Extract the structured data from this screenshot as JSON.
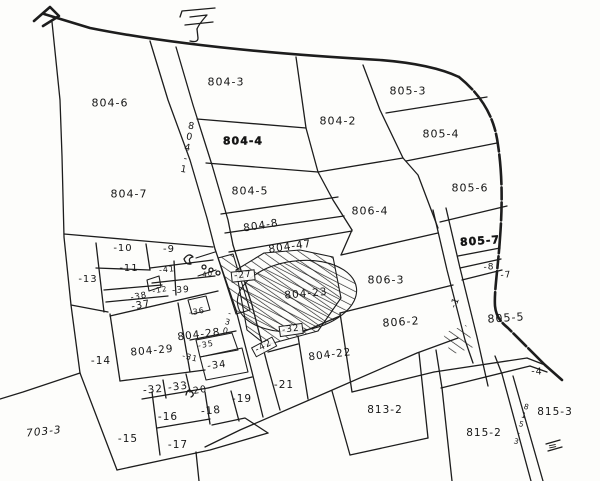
{
  "map": {
    "title_character": "字",
    "background": "#fdfdfb",
    "line_color": "#1d1d1d",
    "labels": [
      {
        "id": "804-6",
        "text": "804-6",
        "x": 110,
        "y": 103
      },
      {
        "id": "804-3",
        "text": "804-3",
        "x": 226,
        "y": 82
      },
      {
        "id": "804-4",
        "text": "804-4",
        "x": 243,
        "y": 141,
        "bold": true
      },
      {
        "id": "804-2",
        "text": "804-2",
        "x": 338,
        "y": 121
      },
      {
        "id": "805-3",
        "text": "805-3",
        "x": 408,
        "y": 91
      },
      {
        "id": "805-4",
        "text": "805-4",
        "x": 441,
        "y": 134
      },
      {
        "id": "805-6",
        "text": "805-6",
        "x": 470,
        "y": 188
      },
      {
        "id": "804-7",
        "text": "804-7",
        "x": 129,
        "y": 194
      },
      {
        "id": "804-5",
        "text": "804-5",
        "x": 250,
        "y": 191
      },
      {
        "id": "804-8",
        "text": "804-8",
        "x": 261,
        "y": 226,
        "rot": -9,
        "size": 10.5
      },
      {
        "id": "806-4",
        "text": "806-4",
        "x": 370,
        "y": 211
      },
      {
        "id": "804-47",
        "text": "804-47",
        "x": 290,
        "y": 247,
        "rot": -8,
        "size": 10.5
      },
      {
        "id": "805-7",
        "text": "805-7",
        "x": 480,
        "y": 241,
        "rot": -4,
        "bold": true
      },
      {
        "id": "m8",
        "text": "-8",
        "x": 489,
        "y": 268,
        "size": 9
      },
      {
        "id": "m7",
        "text": "-7",
        "x": 506,
        "y": 276,
        "size": 9,
        "rot": -4
      },
      {
        "id": "m1",
        "text": "-1",
        "x": 456,
        "y": 303,
        "size": 9,
        "rot": -70
      },
      {
        "id": "805-5",
        "text": "805-5",
        "x": 506,
        "y": 318,
        "rot": -4
      },
      {
        "id": "806-3",
        "text": "806-3",
        "x": 386,
        "y": 280
      },
      {
        "id": "806-2",
        "text": "806-2",
        "x": 401,
        "y": 322,
        "rot": -4
      },
      {
        "id": "804-23",
        "text": "804-23",
        "x": 306,
        "y": 294,
        "rot": -5,
        "size": 10.5
      },
      {
        "id": "m27",
        "text": "-27",
        "x": 243,
        "y": 276,
        "size": 9,
        "rot": -6,
        "boxed": true
      },
      {
        "id": "m10",
        "text": "-10",
        "x": 123,
        "y": 249,
        "size": 10
      },
      {
        "id": "m9",
        "text": "-9",
        "x": 169,
        "y": 250,
        "size": 10
      },
      {
        "id": "m13",
        "text": "-13",
        "x": 88,
        "y": 280,
        "size": 10
      },
      {
        "id": "m11",
        "text": "-11",
        "x": 129,
        "y": 269,
        "size": 10
      },
      {
        "id": "m41",
        "text": "-41",
        "x": 167,
        "y": 270,
        "size": 8,
        "rot": -6
      },
      {
        "id": "m40",
        "text": "-40",
        "x": 206,
        "y": 275,
        "size": 7,
        "rot": -6
      },
      {
        "id": "m39",
        "text": "-39",
        "x": 181,
        "y": 291,
        "size": 9,
        "rot": -4
      },
      {
        "id": "m12",
        "text": "-12",
        "x": 160,
        "y": 290,
        "size": 7.5,
        "rot": -10
      },
      {
        "id": "m38",
        "text": "-38",
        "x": 139,
        "y": 297,
        "size": 8.5,
        "rot": -10
      },
      {
        "id": "m37",
        "text": "-37",
        "x": 141,
        "y": 306,
        "size": 10,
        "rot": -10
      },
      {
        "id": "m36",
        "text": "-36",
        "x": 197,
        "y": 312,
        "size": 8,
        "rot": -10
      },
      {
        "id": "m30",
        "text": "-30",
        "x": 227,
        "y": 322,
        "size": 8,
        "vertical": true,
        "rot": 14
      },
      {
        "id": "804-1",
        "text": "804-1",
        "x": 187,
        "y": 148,
        "size": 9.5,
        "vertical": true,
        "rot": 10
      },
      {
        "id": "804-28",
        "text": "804-28",
        "x": 199,
        "y": 335,
        "size": 10.5,
        "rot": -7
      },
      {
        "id": "804-29",
        "text": "804-29",
        "x": 152,
        "y": 351,
        "size": 10.5,
        "rot": -5
      },
      {
        "id": "m35",
        "text": "-35",
        "x": 206,
        "y": 345,
        "size": 8,
        "rot": -10
      },
      {
        "id": "m31",
        "text": "-31",
        "x": 190,
        "y": 358,
        "size": 8,
        "rot": 14
      },
      {
        "id": "m34",
        "text": "-34",
        "x": 217,
        "y": 366,
        "size": 10,
        "rot": -7
      },
      {
        "id": "m14",
        "text": "-14",
        "x": 101,
        "y": 361,
        "size": 10.5
      },
      {
        "id": "m32a",
        "text": "-32",
        "x": 291,
        "y": 330,
        "size": 9,
        "rot": -8,
        "boxed": true
      },
      {
        "id": "m42",
        "text": "-42",
        "x": 264,
        "y": 347,
        "size": 9,
        "rot": -28,
        "boxed": true
      },
      {
        "id": "m32",
        "text": "-32",
        "x": 153,
        "y": 390,
        "size": 10.5,
        "rot": -5
      },
      {
        "id": "m33",
        "text": "-33",
        "x": 178,
        "y": 387,
        "size": 10.5,
        "rot": -7
      },
      {
        "id": "m20",
        "text": "-20",
        "x": 198,
        "y": 391,
        "size": 9.5,
        "rot": -10
      },
      {
        "id": "m19",
        "text": "-19",
        "x": 242,
        "y": 399,
        "size": 10.5
      },
      {
        "id": "m18",
        "text": "-18",
        "x": 211,
        "y": 411,
        "size": 10.5,
        "rot": -5
      },
      {
        "id": "m16",
        "text": "-16",
        "x": 168,
        "y": 417,
        "size": 10.5
      },
      {
        "id": "m17",
        "text": "-17",
        "x": 178,
        "y": 445,
        "size": 10.5
      },
      {
        "id": "m15",
        "text": "-15",
        "x": 128,
        "y": 439,
        "size": 10.5
      },
      {
        "id": "703-3",
        "text": "703-3",
        "x": 44,
        "y": 432,
        "size": 10.5,
        "italic": true,
        "rot": -6
      },
      {
        "id": "m21",
        "text": "-21",
        "x": 284,
        "y": 385,
        "size": 10.5
      },
      {
        "id": "804-22",
        "text": "804-22",
        "x": 330,
        "y": 355,
        "size": 10.5,
        "rot": -7
      },
      {
        "id": "813-2",
        "text": "813-2",
        "x": 385,
        "y": 410,
        "size": 10.5
      },
      {
        "id": "815-2",
        "text": "815-2",
        "x": 484,
        "y": 433,
        "size": 10.5
      },
      {
        "id": "815-3",
        "text": "815-3",
        "x": 555,
        "y": 412,
        "size": 10.5
      },
      {
        "id": "m4",
        "text": "-4",
        "x": 537,
        "y": 372,
        "size": 9.5
      },
      {
        "id": "815-3v",
        "text": "815-3",
        "x": 521,
        "y": 424,
        "size": 7.5,
        "vertical": true,
        "rot": 16
      },
      {
        "id": "equals-mark",
        "text": "=",
        "x": 553,
        "y": 446,
        "size": 11,
        "rot": -12
      }
    ]
  }
}
